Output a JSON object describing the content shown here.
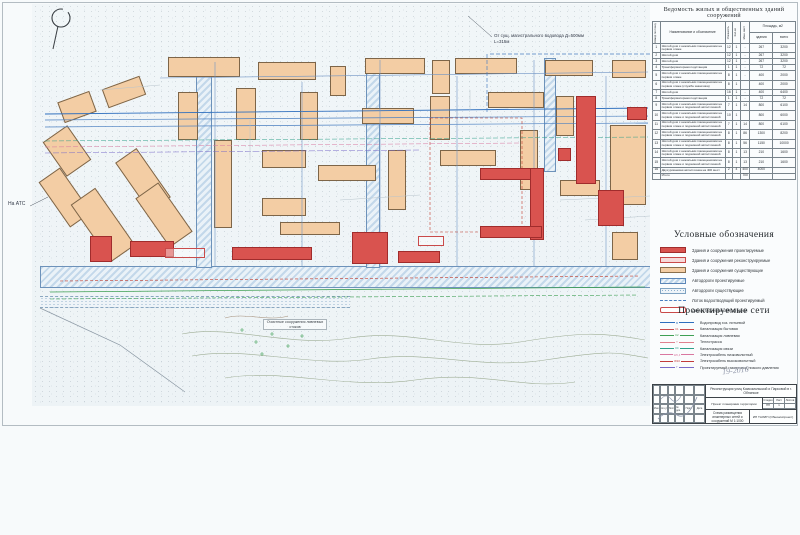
{
  "colors": {
    "projected_building": "#d9534f",
    "existing_building": "#f3cda4",
    "road_blue": "#6d92ba",
    "water_line": "#2f6fbe"
  },
  "table": {
    "title": "Ведомость жилых и общественных зданий сооружений",
    "headers": {
      "num": "Номер по плану",
      "name": "Наименование и обозначение",
      "floors": "Этажность",
      "count": "Кол-во",
      "spots": "Маш. мест",
      "area": "Площадь, м2",
      "area_bld": "здания",
      "area_total": "всего"
    },
    "rows": [
      [
        "1",
        "Жилой дом с нежилыми помещениями на первом этаже",
        "12",
        "1",
        "-",
        "267",
        "3200"
      ],
      [
        "2",
        "Жилой дом",
        "12",
        "1",
        "-",
        "267",
        "3200"
      ],
      [
        "3",
        "Жилой дом",
        "12",
        "1",
        "-",
        "267",
        "3200"
      ],
      [
        "4",
        "Трансформаторная подстанция",
        "1",
        "1",
        "-",
        "72",
        "72"
      ],
      [
        "5",
        "Жилой дом с нежилыми помещениями на первом этаже",
        "8",
        "1",
        "-",
        "400",
        "2000"
      ],
      [
        "6",
        "Жилой дом с нежилыми помещениями на первом этаже (служба заказчика)",
        "8",
        "1",
        "",
        "400",
        "2000"
      ],
      [
        "7",
        "Жилой дом",
        "16",
        "1",
        "-",
        "400",
        "6400"
      ],
      [
        "8",
        "Трансформаторная подстанция",
        "1",
        "1",
        "-",
        "72",
        "72"
      ],
      [
        "9",
        "Жилой дом с нежилыми помещениями на первом этаже и подземной автостоянкой",
        "7",
        "1",
        "14",
        "800",
        "6100"
      ],
      [
        "10",
        "Жилой дом с нежилыми помещениями на первом этаже и подземной автостоянкой",
        "10",
        "1",
        "",
        "800",
        "6000"
      ],
      [
        "11",
        "Жилой дом с нежилыми помещениями на первом этаже и подземной автостоянкой",
        "7",
        "1",
        "14",
        "800",
        "6100"
      ],
      [
        "12",
        "Жилой дом с нежилыми помещениями на первом этаже и подземной автостоянкой",
        "8",
        "1",
        "86",
        "1300",
        "8200"
      ],
      [
        "13",
        "Жилой дом с нежилыми помещениями на первом этаже и подземной автостоянкой",
        "8",
        "1",
        "56",
        "1150",
        "10000"
      ],
      [
        "14",
        "Жилой дом с нежилыми помещениями на первом этаже и подземной автостоянкой",
        "8",
        "1",
        "13",
        "210",
        "1600"
      ],
      [
        "15",
        "Жилой дом с нежилыми помещениями на первом этаже и подземной автостоянкой",
        "8",
        "1",
        "13",
        "210",
        "1600"
      ],
      [
        "16",
        "Двухуровневая автостоянка на 400 мест",
        "2",
        "4",
        "400",
        "4000",
        ""
      ]
    ],
    "total": {
      "label": "Итого",
      "value": "700"
    }
  },
  "legend": {
    "title": "Условные обозначения",
    "items": [
      {
        "type": "projected",
        "label": "Здания и сооружения проектируемые"
      },
      {
        "type": "reconstructed",
        "label": "Здания и сооружения реконструируемые"
      },
      {
        "type": "existing",
        "label": "Здания и сооружения существующие"
      },
      {
        "type": "road-projected",
        "label": "Автодороги проектируемые"
      },
      {
        "type": "road-existing",
        "label": "Автодороги существующие"
      },
      {
        "type": "drain",
        "label": "Лоток водоотводящий проектируемый"
      },
      {
        "type": "demolished",
        "label": "Демонтируемые автостоянки"
      }
    ]
  },
  "networks": {
    "title": "Проектируемые сети",
    "items": [
      {
        "tag": "В",
        "color": "#2f6fbe",
        "label": "Водопровод хоз. питьевой"
      },
      {
        "tag": "К1",
        "color": "#c94a4a",
        "label": "Канализация бытовая"
      },
      {
        "tag": "К2",
        "color": "#3fa054",
        "label": "Канализация ливневая"
      },
      {
        "tag": "Т",
        "color": "#e0818f",
        "label": "Теплотрасса"
      },
      {
        "tag": "КС",
        "color": "#2fa08a",
        "label": "Канализация связи"
      },
      {
        "tag": "W0,4",
        "color": "#d977a0",
        "label": "Электрокабель низковольтный"
      },
      {
        "tag": "W10",
        "color": "#c23b3b",
        "label": "Электрокабель высоковольтный"
      },
      {
        "tag": "Г",
        "color": "#7a6bc9",
        "label": "Проектируемый газопровод низкого давления"
      }
    ]
  },
  "stamp": {
    "project": "Реконструкция улиц Комсомольской и Парковой в г. Обнинске",
    "doc_type": "Проект планировки территории",
    "stage_label": "Стадия",
    "sheet_label": "Лист",
    "sheets_label": "Листов",
    "stage": "ПП",
    "sheet": "1",
    "sheets": "",
    "drawing_title": "Схема размещения инженерных сетей и сооружений М 1:1000",
    "organization": "ИП ТАЛИН (Обнинскпроект)",
    "sig_cols": [
      "Изм.",
      "Кол.уч",
      "Лист",
      "№ док.",
      "Подп.",
      "Дата"
    ]
  },
  "annotations": {
    "water_note_1": "От сущ. магистрального водовода Д=500мм",
    "water_note_2": "L=315м",
    "ats": "На АТС",
    "treatment": "Очистные сооружения ливневых стоков",
    "handwritten": "19-2016",
    "north": "С"
  },
  "map": {
    "existing": [
      {
        "x": 168,
        "y": 57,
        "w": 72,
        "h": 20
      },
      {
        "x": 258,
        "y": 62,
        "w": 58,
        "h": 18
      },
      {
        "x": 330,
        "y": 66,
        "w": 16,
        "h": 30
      },
      {
        "x": 365,
        "y": 58,
        "w": 60,
        "h": 16
      },
      {
        "x": 432,
        "y": 60,
        "w": 18,
        "h": 34
      },
      {
        "x": 455,
        "y": 58,
        "w": 62,
        "h": 16
      },
      {
        "x": 545,
        "y": 60,
        "w": 48,
        "h": 16
      },
      {
        "x": 612,
        "y": 60,
        "w": 34,
        "h": 18
      },
      {
        "x": 60,
        "y": 96,
        "w": 34,
        "h": 22,
        "r": -20
      },
      {
        "x": 104,
        "y": 82,
        "w": 40,
        "h": 20,
        "r": -20
      },
      {
        "x": 52,
        "y": 130,
        "w": 30,
        "h": 42,
        "r": -35
      },
      {
        "x": 52,
        "y": 170,
        "w": 26,
        "h": 55,
        "r": -35
      },
      {
        "x": 88,
        "y": 190,
        "w": 30,
        "h": 70,
        "r": -35
      },
      {
        "x": 130,
        "y": 150,
        "w": 26,
        "h": 60,
        "r": -35
      },
      {
        "x": 150,
        "y": 185,
        "w": 28,
        "h": 60,
        "r": -35
      },
      {
        "x": 178,
        "y": 92,
        "w": 20,
        "h": 48
      },
      {
        "x": 236,
        "y": 88,
        "w": 20,
        "h": 52
      },
      {
        "x": 300,
        "y": 92,
        "w": 18,
        "h": 48
      },
      {
        "x": 362,
        "y": 108,
        "w": 52,
        "h": 16
      },
      {
        "x": 430,
        "y": 96,
        "w": 20,
        "h": 44
      },
      {
        "x": 488,
        "y": 92,
        "w": 56,
        "h": 16
      },
      {
        "x": 556,
        "y": 96,
        "w": 18,
        "h": 40
      },
      {
        "x": 214,
        "y": 140,
        "w": 18,
        "h": 88
      },
      {
        "x": 262,
        "y": 150,
        "w": 44,
        "h": 18
      },
      {
        "x": 262,
        "y": 198,
        "w": 44,
        "h": 18
      },
      {
        "x": 318,
        "y": 165,
        "w": 58,
        "h": 16
      },
      {
        "x": 280,
        "y": 222,
        "w": 60,
        "h": 13
      },
      {
        "x": 388,
        "y": 150,
        "w": 18,
        "h": 60
      },
      {
        "x": 440,
        "y": 150,
        "w": 56,
        "h": 16
      },
      {
        "x": 610,
        "y": 125,
        "w": 36,
        "h": 80
      },
      {
        "x": 520,
        "y": 130,
        "w": 18,
        "h": 60
      },
      {
        "x": 560,
        "y": 180,
        "w": 40,
        "h": 16
      },
      {
        "x": 612,
        "y": 232,
        "w": 26,
        "h": 28
      }
    ],
    "projected": [
      {
        "x": 90,
        "y": 236,
        "w": 22,
        "h": 26
      },
      {
        "x": 130,
        "y": 241,
        "w": 44,
        "h": 16
      },
      {
        "x": 232,
        "y": 247,
        "w": 80,
        "h": 13
      },
      {
        "x": 352,
        "y": 232,
        "w": 36,
        "h": 32
      },
      {
        "x": 398,
        "y": 251,
        "w": 42,
        "h": 12
      },
      {
        "x": 480,
        "y": 168,
        "w": 62,
        "h": 12
      },
      {
        "x": 530,
        "y": 168,
        "w": 14,
        "h": 72
      },
      {
        "x": 480,
        "y": 226,
        "w": 62,
        "h": 12
      },
      {
        "x": 576,
        "y": 96,
        "w": 20,
        "h": 88
      },
      {
        "x": 558,
        "y": 148,
        "w": 13,
        "h": 13
      },
      {
        "x": 598,
        "y": 190,
        "w": 26,
        "h": 36
      },
      {
        "x": 627,
        "y": 107,
        "w": 20,
        "h": 13
      }
    ],
    "demolished": [
      {
        "x": 165,
        "y": 248,
        "w": 40,
        "h": 10
      },
      {
        "x": 418,
        "y": 236,
        "w": 26,
        "h": 10
      }
    ],
    "roads": [
      {
        "k": "proj",
        "x": 40,
        "y": 266,
        "w": 614,
        "h": 22
      },
      {
        "k": "proj",
        "x": 196,
        "y": 60,
        "w": 16,
        "h": 208
      },
      {
        "k": "proj",
        "x": 366,
        "y": 58,
        "w": 14,
        "h": 210
      },
      {
        "k": "proj",
        "x": 544,
        "y": 58,
        "w": 12,
        "h": 114
      },
      {
        "k": "exist",
        "x": 40,
        "y": 296,
        "w": 310,
        "h": 12
      }
    ],
    "lines": [
      {
        "p": "45,114 648,108",
        "c": "#2f6fbe",
        "w": 0.9,
        "n": "water-main-line"
      },
      {
        "p": "45,120 648,116",
        "c": "#4a7fc1",
        "w": 0.7
      },
      {
        "p": "45,127 648,123",
        "c": "#4a7fc1",
        "w": 0.7
      },
      {
        "p": "160,78 648,72",
        "c": "#6f94c4",
        "w": 0.6
      },
      {
        "p": "215,62 215,266",
        "c": "#6f94c4",
        "w": 0.6
      },
      {
        "p": "302,82 302,266",
        "c": "#6f94c4",
        "w": 0.6
      },
      {
        "p": "380,60 380,266",
        "c": "#6f94c4",
        "w": 0.6
      },
      {
        "p": "457,76 457,266",
        "c": "#6f94c4",
        "w": 0.6
      },
      {
        "p": "534,60 534,266",
        "c": "#6f94c4",
        "w": 0.6
      },
      {
        "p": "606,76 606,266",
        "c": "#6f94c4",
        "w": 0.6
      },
      {
        "p": "50,292 645,287",
        "c": "#3fa054",
        "w": 0.8,
        "n": "storm-sewer-line"
      },
      {
        "p": "50,299 638,295",
        "c": "#3fa054",
        "w": 0.6,
        "d": "4,2"
      },
      {
        "p": "60,281 640,276",
        "c": "#c0392b",
        "w": 0.6,
        "d": "3,2",
        "n": "power-cable-line"
      },
      {
        "p": "430,118 522,118 522,232 430,232 430,118",
        "c": "#c0392b",
        "w": 0.6,
        "d": "3,2"
      },
      {
        "p": "45,141 648,137",
        "c": "#2fa08a",
        "w": 0.5,
        "d": "5,2"
      },
      {
        "p": "45,147 520,143",
        "c": "#d977a0",
        "w": 0.5,
        "d": "5,2"
      },
      {
        "p": "45,153 420,150",
        "c": "#7a6bc9",
        "w": 0.5,
        "d": "6,2"
      },
      {
        "p": "487,54 487,112",
        "c": "#4a7fc1",
        "w": 0.7,
        "d": "4,2"
      },
      {
        "p": "490,54 650,54",
        "c": "#4a7fc1",
        "w": 0.7,
        "d": "4,2"
      },
      {
        "p": "468,16 492,37",
        "c": "#4c5560",
        "w": 0.5,
        "n": "leader-line"
      },
      {
        "p": "30,206 48,197",
        "c": "#4c5560",
        "w": 0.5,
        "n": "leader-line"
      },
      {
        "p": "40,308 120,345 185,392",
        "c": "#8b98a3",
        "w": 0.7,
        "n": "shore-line"
      },
      {
        "p": "100,90 160,85",
        "c": "#b8c4cc",
        "w": 0.5
      },
      {
        "p": "340,200 420,195",
        "c": "#b8c4cc",
        "w": 0.5
      },
      {
        "p": "560,200 650,196",
        "c": "#b8c4cc",
        "w": 0.5
      },
      {
        "p": "250,120 250,160",
        "c": "#b8c4cc",
        "w": 0.5
      },
      {
        "p": "470,90 470,110",
        "c": "#b8c4cc",
        "w": 0.5
      },
      {
        "p": "585,220 650,216",
        "c": "#b8c4cc",
        "w": 0.5
      }
    ],
    "contours": [
      {
        "d": "M182,334 C230,324 290,348 350,338 S460,352 520,342 S600,332 645,340",
        "c": "#9fae95"
      },
      {
        "d": "M192,356 C250,346 310,368 370,359 S480,370 545,360 S615,352 648,358",
        "c": "#9fae95"
      },
      {
        "d": "M225,378 C285,368 345,390 415,380 S520,390 575,382",
        "c": "#9fae95"
      },
      {
        "d": "M225,318 C245,312 268,322 288,316",
        "c": "#a8937d"
      }
    ],
    "crosses": [
      [
        242,
        330
      ],
      [
        256,
        342
      ],
      [
        272,
        334
      ],
      [
        288,
        346
      ],
      [
        302,
        336
      ],
      [
        262,
        354
      ]
    ]
  }
}
